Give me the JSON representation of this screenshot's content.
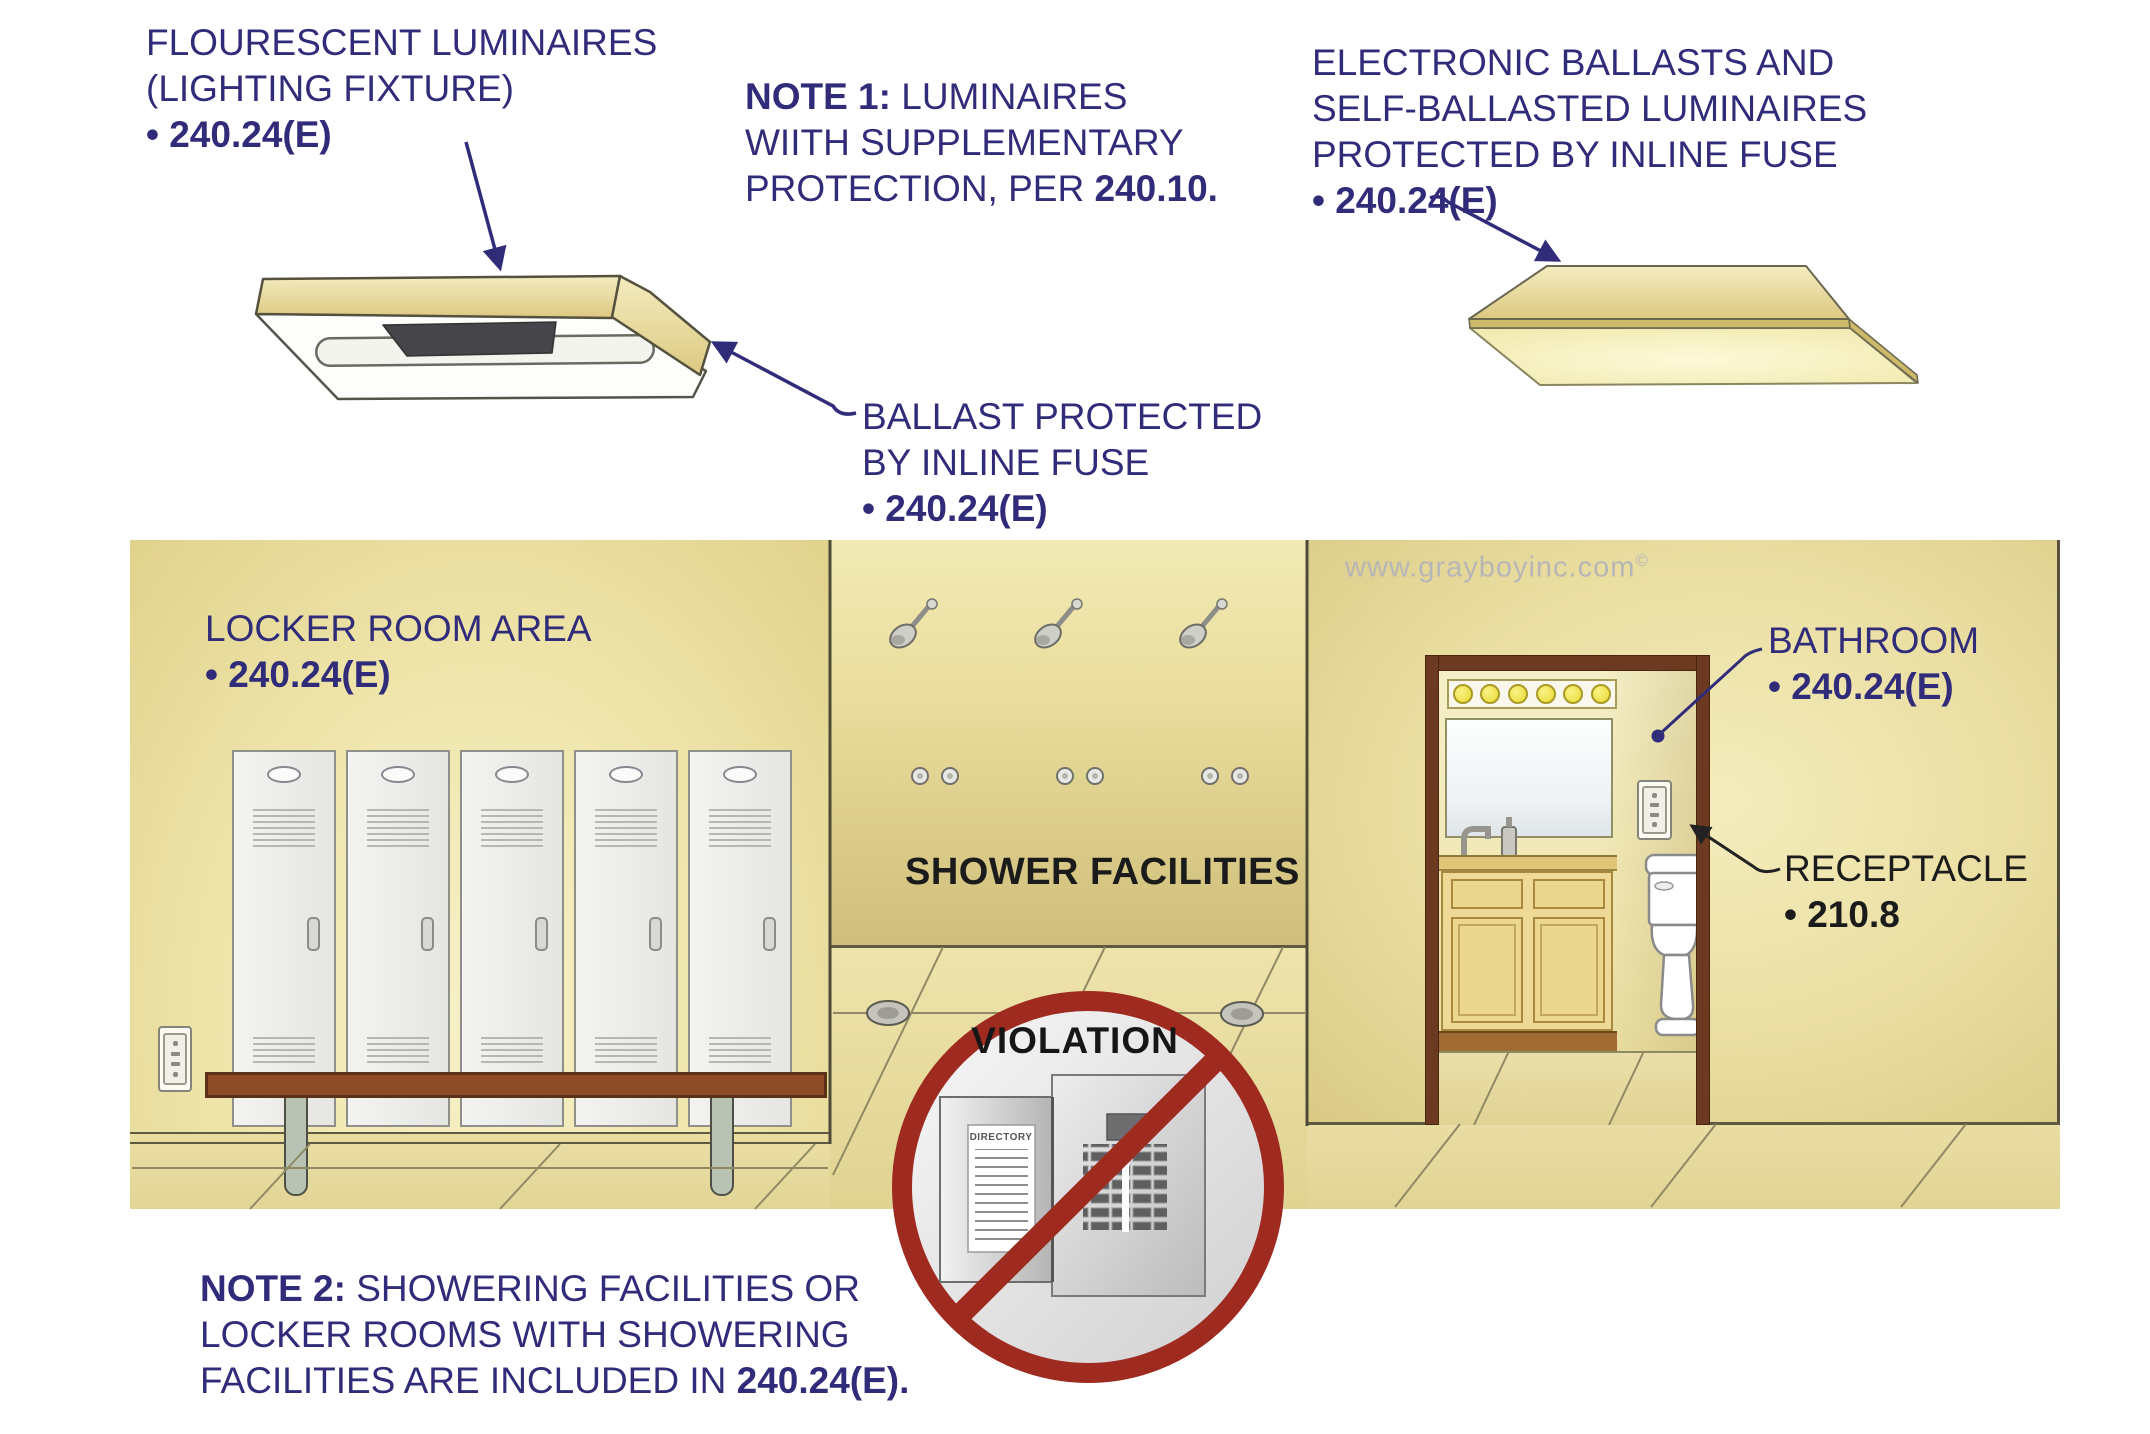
{
  "labels": {
    "fluorescent": {
      "line1": "FLOURESCENT LUMINAIRES",
      "line2": "(LIGHTING FIXTURE)",
      "code": "• 240.24(E)"
    },
    "note1": {
      "bold": "NOTE 1:",
      "rest": " LUMINAIRES",
      "line2": "WIITH SUPPLEMENTARY",
      "line3": "PROTECTION, PER ",
      "line3_bold": "240.10."
    },
    "electronic": {
      "line1": "ELECTRONIC BALLASTS AND",
      "line2": "SELF-BALLASTED LUMINAIRES",
      "line3": "PROTECTED BY INLINE FUSE",
      "code": "• 240.24(E)"
    },
    "ballast": {
      "line1": "BALLAST PROTECTED",
      "line2": "BY INLINE FUSE",
      "code": "• 240.24(E)"
    },
    "locker_room": {
      "line1": "LOCKER ROOM AREA",
      "code": "• 240.24(E)"
    },
    "bathroom": {
      "line1": "BATHROOM",
      "code": "• 240.24(E)"
    },
    "receptacle": {
      "line1": "RECEPTACLE",
      "code": "• 210.8"
    },
    "shower_facilities": "SHOWER FACILITIES",
    "violation": "VIOLATION",
    "directory": "DIRECTORY",
    "note2": {
      "bold": "NOTE 2:",
      "rest": " SHOWERING FACILITIES OR",
      "line2": "LOCKER ROOMS WITH SHOWERING",
      "line3": "FACILITIES ARE INCLUDED IN ",
      "line3_bold": "240.24(E)."
    },
    "watermark": {
      "text": "www.grayboyinc.com",
      "mark": "©"
    }
  },
  "colors": {
    "annotation_navy": "#312c7a",
    "black_text": "#1b1b1b",
    "violation_red": "#9e2a20",
    "wall_yellow": "#eee4a9",
    "shower_wall_gold": "#d9c987",
    "door_frame_brown": "#6b3a20",
    "bench_brown": "#8d4c26",
    "locker_gray": "#ebebe9",
    "watermark_gray": "#b6b6b6"
  }
}
